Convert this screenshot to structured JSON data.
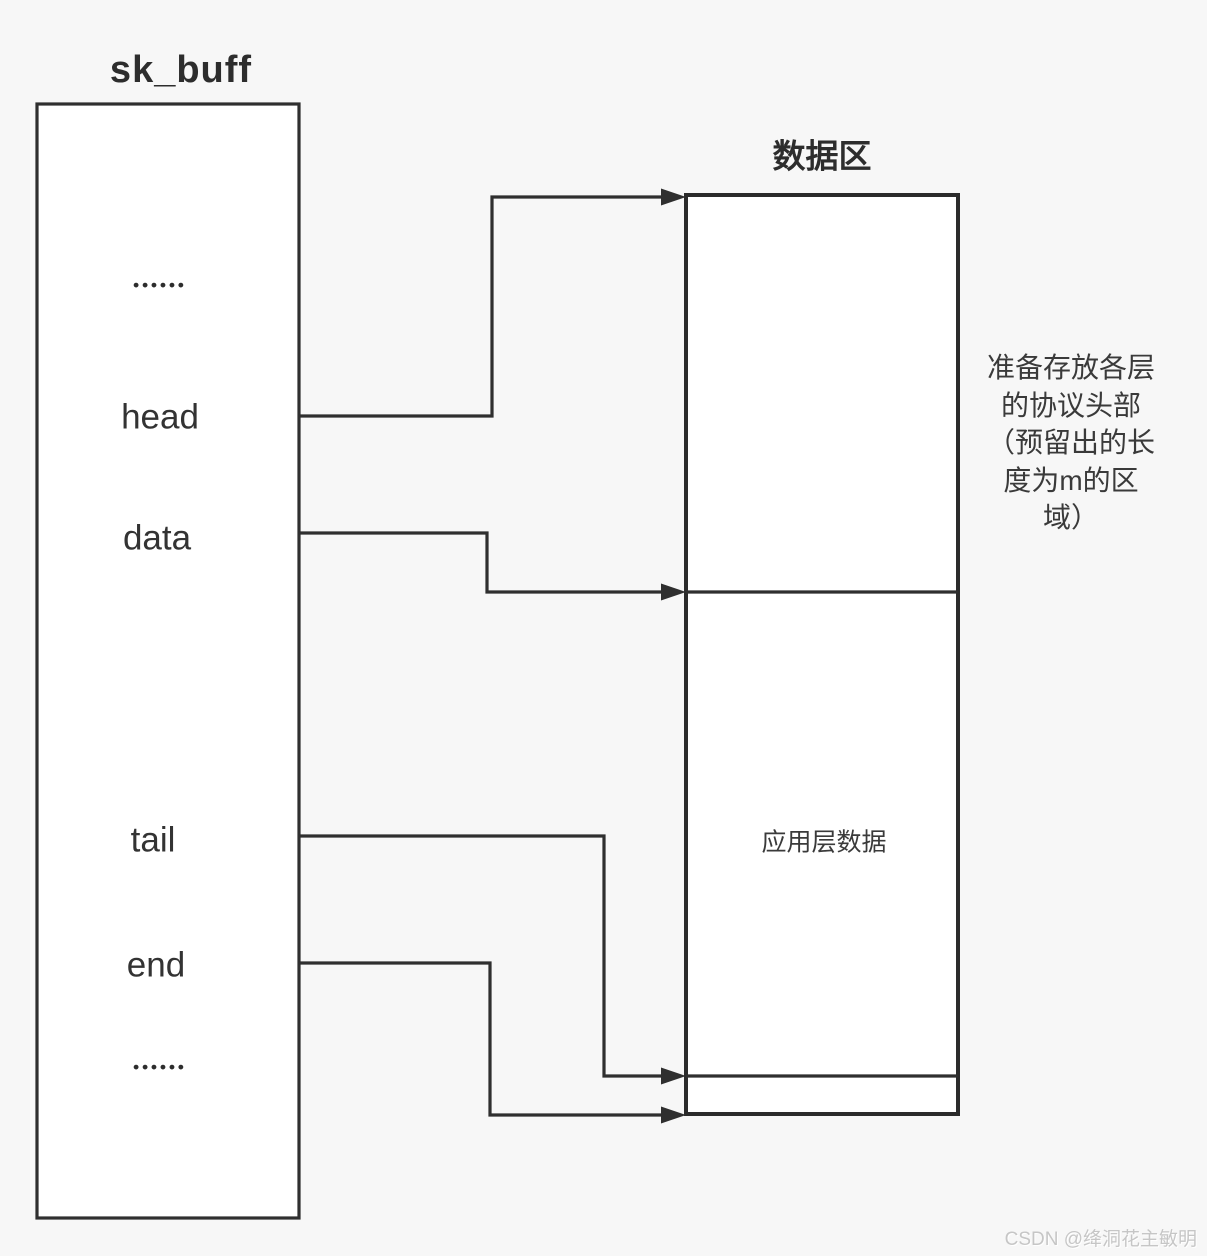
{
  "colors": {
    "background": "#f7f7f7",
    "line": "#333333",
    "box_fill": "#ffffff",
    "text": "#303030",
    "watermark": "#c6c6c6"
  },
  "skbuff": {
    "title": "sk_buff",
    "ellipsis_top": "••••••",
    "fields": [
      "head",
      "data",
      "tail",
      "end"
    ],
    "ellipsis_bottom": "••••••"
  },
  "data_area": {
    "title": "数据区",
    "app_data_label": "应用层数据",
    "annotation_lines": [
      "准备存放各层",
      "的协议头部",
      "（预留出的长",
      "度为m的区",
      "域）"
    ]
  },
  "pointers": [
    {
      "name": "head",
      "points_to": "data-area-top"
    },
    {
      "name": "data",
      "points_to": "protocol-header-boundary"
    },
    {
      "name": "tail",
      "points_to": "application-data-end"
    },
    {
      "name": "end",
      "points_to": "data-area-bottom"
    }
  ],
  "watermark": {
    "text": "CSDN @绛洞花主敏明"
  }
}
